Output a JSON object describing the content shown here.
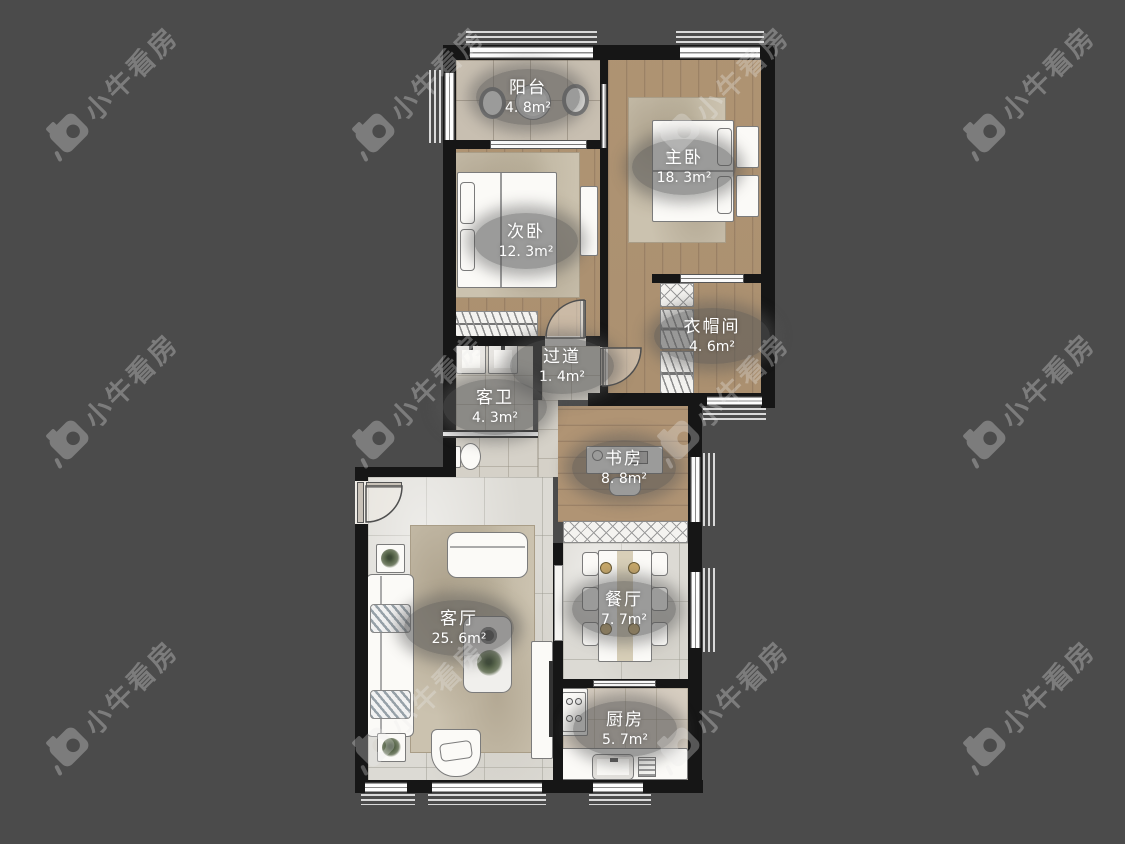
{
  "app": {
    "watermark_text": "小牛看房"
  },
  "rooms": {
    "balcony": {
      "name": "阳台",
      "area": "4. 8m²"
    },
    "master": {
      "name": "主卧",
      "area": "18. 3m²"
    },
    "second": {
      "name": "次卧",
      "area": "12. 3m²"
    },
    "cloak": {
      "name": "衣帽间",
      "area": "4. 6m²"
    },
    "corridor": {
      "name": "过道",
      "area": "1. 4m²"
    },
    "bath": {
      "name": "客卫",
      "area": "4. 3m²"
    },
    "study": {
      "name": "书房",
      "area": "8. 8m²"
    },
    "living": {
      "name": "客厅",
      "area": "25. 6m²"
    },
    "dining": {
      "name": "餐厅",
      "area": "7. 7m²"
    },
    "kitchen": {
      "name": "厨房",
      "area": "5. 7m²"
    }
  },
  "colors": {
    "background": "#4b4b4b",
    "wall": "#161616",
    "wood_floor": "#b29776",
    "marble_floor": "#dcdad4",
    "badge": "rgba(86,86,86,0.58)",
    "badge_text": "#ffffff",
    "watermark": "#ececec"
  }
}
